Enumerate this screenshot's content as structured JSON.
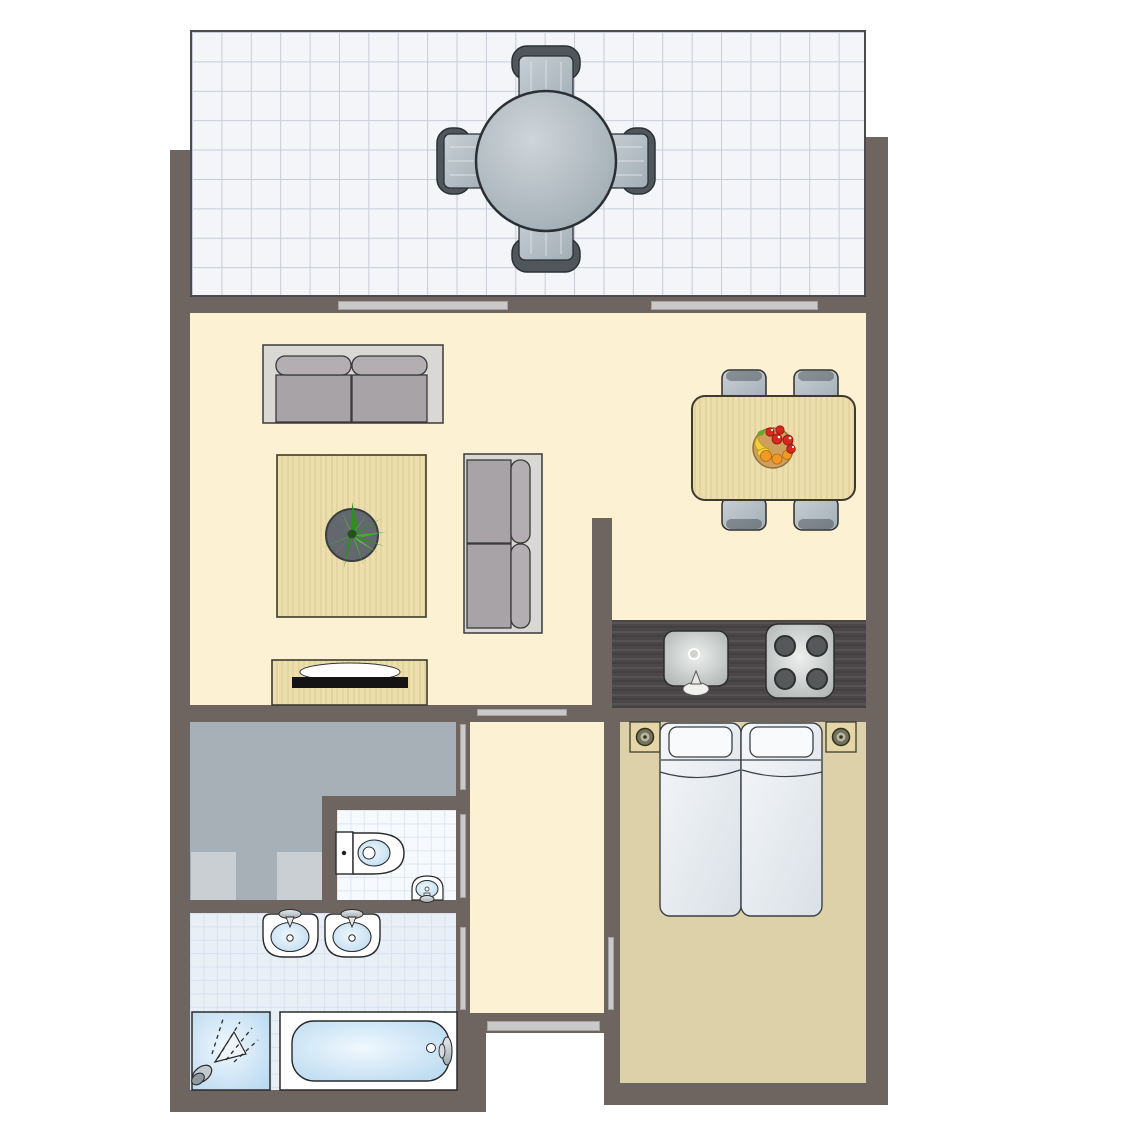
{
  "floorplan": {
    "type": "apartment-top-view",
    "rooms": [
      {
        "name": "terrace",
        "floor": "white-grid-tiles",
        "position": "top"
      },
      {
        "name": "living-room",
        "floor": "cream",
        "position": "center-left"
      },
      {
        "name": "dining-area",
        "floor": "cream",
        "position": "center-right"
      },
      {
        "name": "kitchen",
        "floor": "cream-with-dark-counter",
        "position": "right-middle"
      },
      {
        "name": "hallway",
        "floor": "cream",
        "position": "center-bottom"
      },
      {
        "name": "storage-room",
        "floor": "gray",
        "position": "bottom-left-upper"
      },
      {
        "name": "toilet-room",
        "floor": "white-blue-tiles",
        "position": "bottom-middle-left"
      },
      {
        "name": "bathroom",
        "floor": "blue-tiles",
        "position": "bottom-left-lower"
      },
      {
        "name": "bedroom",
        "floor": "tan",
        "position": "bottom-right"
      },
      {
        "name": "entrance",
        "floor": "open",
        "position": "bottom-center"
      }
    ],
    "furniture": {
      "terrace": [
        "round-patio-table",
        "patio-chair-top",
        "patio-chair-bottom",
        "patio-chair-left",
        "patio-chair-right"
      ],
      "living_room": [
        "two-seat-sofa-horizontal",
        "two-seat-sofa-vertical",
        "wooden-coffee-table",
        "potted-plant",
        "tv-console",
        "flat-tv"
      ],
      "dining_area": [
        "wooden-dining-table",
        "dining-chair x4",
        "fruit-bowl"
      ],
      "kitchen": [
        "dark-counter",
        "kitchen-sink-with-faucet",
        "stove-4-burners"
      ],
      "bedroom": [
        "twin-bed x2",
        "pillow x2",
        "nightstand-with-lamp x2"
      ],
      "storage_room": [
        "appliance x2"
      ],
      "toilet_room": [
        "toilet",
        "corner-hand-basin"
      ],
      "bathroom": [
        "wash-basin x2",
        "shower-with-sprayhead",
        "bathtub-with-faucet"
      ]
    },
    "openings": {
      "terrace_windows": 2,
      "interior_door_markers": [
        "living-to-hallway",
        "hallway-to-storage",
        "hallway-to-toilet",
        "hallway-to-bathroom",
        "hallway-to-bedroom"
      ],
      "entrance_door": 1
    },
    "counts": {
      "burners": 4,
      "beds": 2,
      "basins": 2,
      "patio_chairs": 4,
      "dining_chairs": 4
    }
  },
  "colors": {
    "wall": "#6e6561",
    "marker": "#c9c9c9",
    "floor_cream": "#fcf2d3",
    "floor_bedroom": "#ddd1a9",
    "floor_storage": "#a6b0b6",
    "appliance": "#c9cfd3",
    "terrace_tile": "#f3f5f9",
    "terrace_grid": "#c7ccd6",
    "bath_tile": "#e9eff7",
    "bath_grid": "#d8e1f0",
    "toilet_tile": "#f6f9fd",
    "toilet_grid": "#dee8f4",
    "counter_dark": "#4b4749",
    "wood_light": "#ecdead",
    "fixture_blue": "#bdddf2",
    "fixture_white": "#ffffff",
    "sofa_gray": "#a7a3a7",
    "chair_gray": "#9aa3af",
    "plant_green": "#46ad2f",
    "fruit_red": "#d6281c",
    "fruit_orange": "#f09a25",
    "fruit_yellow": "#f3cf3a",
    "outline_dark": "#2b3034"
  }
}
